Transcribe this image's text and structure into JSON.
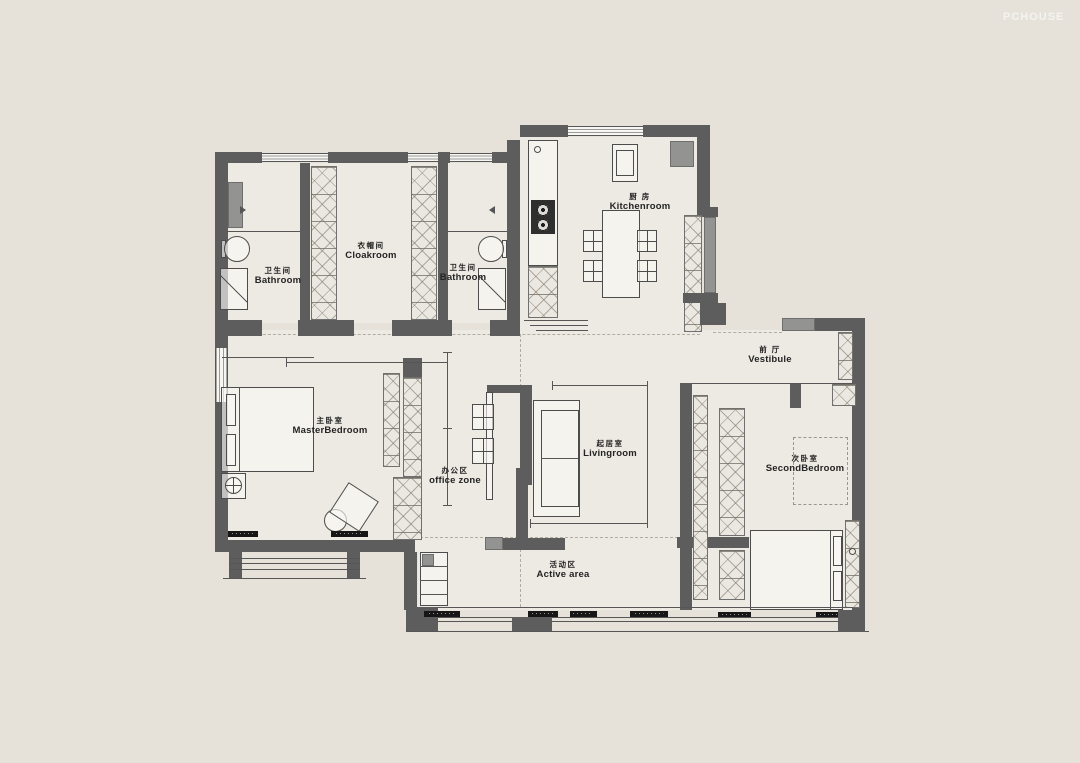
{
  "watermark": "PCHOUSE",
  "palette": {
    "background": "#e6e2da",
    "floor": "#edeae3",
    "wall": "#5d5d5d",
    "wall_light": "#939391",
    "hatch_fill": "#ebe8e1",
    "furniture_line": "#4c4c4c",
    "label_text": "#242424",
    "tag_bg": "#161616"
  },
  "rooms": [
    {
      "id": "bathroom-1",
      "zh": "卫生间",
      "en": "Bathroom"
    },
    {
      "id": "cloakroom",
      "zh": "衣帽间",
      "en": "Cloakroom"
    },
    {
      "id": "bathroom-2",
      "zh": "卫生间",
      "en": "Bathroom"
    },
    {
      "id": "kitchen",
      "zh": "厨 房",
      "en": "Kitchenroom"
    },
    {
      "id": "vestibule",
      "zh": "前 厅",
      "en": "Vestibule"
    },
    {
      "id": "master-bedroom",
      "zh": "主卧室",
      "en": "MasterBedroom"
    },
    {
      "id": "office-zone",
      "zh": "办公区",
      "en": "office zone"
    },
    {
      "id": "living-room",
      "zh": "起居室",
      "en": "Livingroom"
    },
    {
      "id": "second-bedroom",
      "zh": "次卧室",
      "en": "SecondBedroom"
    },
    {
      "id": "active-area",
      "zh": "活动区",
      "en": "Active area"
    }
  ]
}
